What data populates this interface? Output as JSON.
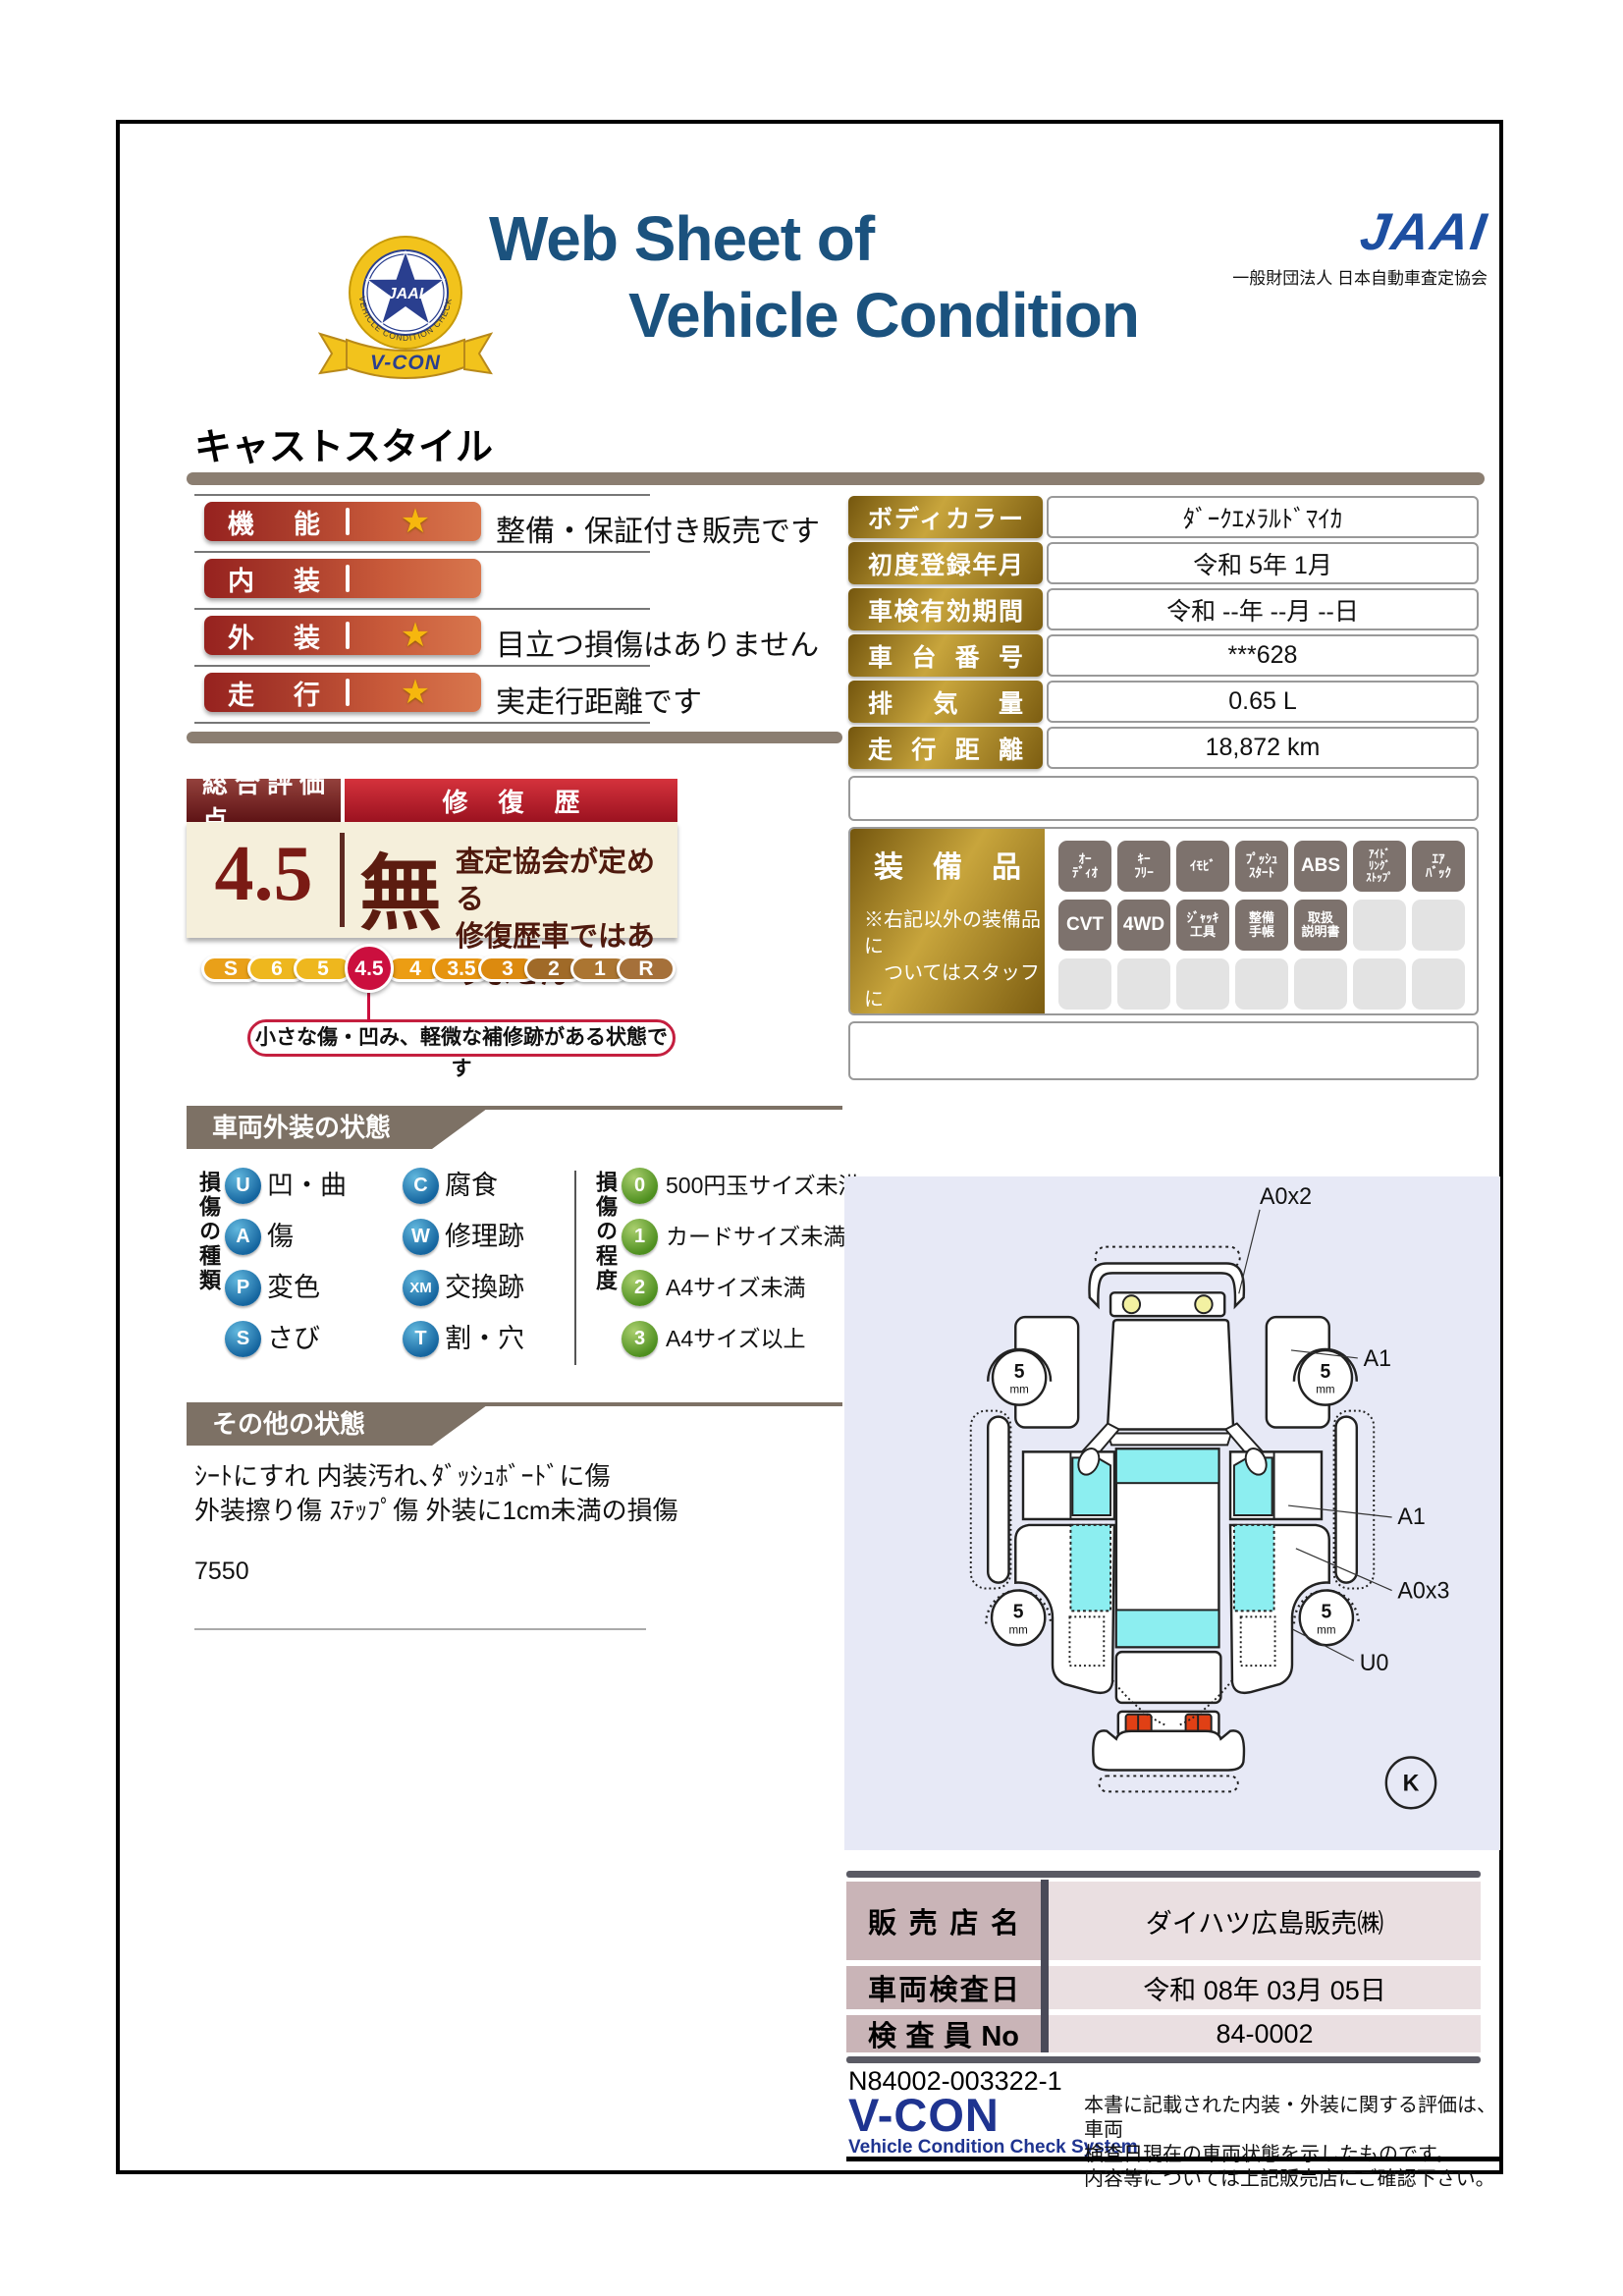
{
  "colors": {
    "title_blue": "#1b527e",
    "jaai_blue": "#1d4fa1",
    "accent_red": "#c41f3f",
    "maroon": "#5e1315",
    "bar_red": "#96221f",
    "gold": "#c8a53c",
    "cyan": "#8ceef0",
    "lavender": "#e7e9f6",
    "banner_gray": "#7d7165",
    "pink_label": "#c9b4b7",
    "selected_grade": "#cb0f3e"
  },
  "header": {
    "title_line1": "Web Sheet of",
    "title_line2": "Vehicle Condition",
    "jaai_word": "JAAI",
    "jaai_org": "一般財団法人 日本自動車査定協会",
    "badge_ring": "VEHICLE CONDITION CHECK SYSTEM",
    "badge_star": "JAAI",
    "badge_ribbon": "V-CON"
  },
  "vehicle_name": "キャストスタイル",
  "icons": {
    "star": "★"
  },
  "ratings": [
    {
      "label": "機能",
      "description": "整備・保証付き販売です"
    },
    {
      "label": "内装",
      "description": ""
    },
    {
      "label": "外装",
      "description": "目立つ損傷はありません"
    },
    {
      "label": "走行",
      "description": "実走行距離です"
    }
  ],
  "spec": {
    "rows": [
      {
        "label": "ボディカラー",
        "value": "ﾀﾞｰｸｴﾒﾗﾙﾄﾞﾏｲｶ"
      },
      {
        "label": "初度登録年月",
        "value": "令和 5年 1月"
      },
      {
        "label": "車検有効期間",
        "value": "令和 --年 --月 --日"
      },
      {
        "label": "車台番号",
        "value": "***628"
      },
      {
        "label": "排気量",
        "value": "0.65 L"
      },
      {
        "label": "走行距離",
        "value": "18,872 km"
      }
    ]
  },
  "overall": {
    "header_score": "総合評価点",
    "header_repair": "修復歴",
    "score": "4.5",
    "repair": "無",
    "repair_note": "査定協会が定める\n修復歴車ではありません",
    "scale": [
      "S",
      "6",
      "5",
      "4.5",
      "4",
      "3.5",
      "3",
      "2",
      "1",
      "R"
    ],
    "selected": "4.5",
    "callout": "小さな傷・凹み、軽微な補修跡がある状態です"
  },
  "equipment": {
    "title": "装備品",
    "note": "※右記以外の装備品に\n　ついてはスタッフに\n　お尋ねください。",
    "items": [
      "ｵｰ\nﾃﾞｨｵ",
      "ｷｰ\nﾌﾘｰ",
      "ｲﾓﾋﾞ",
      "ﾌﾟｯｼｭ\nｽﾀｰﾄ",
      "ABS",
      "ｱｲﾄﾞ\nﾘﾝｸﾞ\nｽﾄｯﾌﾟ",
      "ｴｱ\nﾊﾞｯｸ",
      "CVT",
      "4WD",
      "ｼﾞｬｯｷ\n工具",
      "整備\n手帳",
      "取扱\n説明書"
    ]
  },
  "exterior": {
    "banner": "車両外装の状態",
    "kind_title": "損傷の種類",
    "kinds": [
      {
        "code": "U",
        "label": "凹・曲"
      },
      {
        "code": "A",
        "label": "傷"
      },
      {
        "code": "P",
        "label": "変色"
      },
      {
        "code": "S",
        "label": "さび"
      },
      {
        "code": "C",
        "label": "腐食"
      },
      {
        "code": "W",
        "label": "修理跡"
      },
      {
        "code": "XM",
        "label": "交換跡"
      },
      {
        "code": "T",
        "label": "割・穴"
      }
    ],
    "degree_title": "損傷の程度",
    "degrees": [
      {
        "code": "0",
        "label": "500円玉サイズ未満"
      },
      {
        "code": "1",
        "label": "カードサイズ未満"
      },
      {
        "code": "2",
        "label": "A4サイズ未満"
      },
      {
        "code": "3",
        "label": "A4サイズ以上"
      }
    ]
  },
  "other_state": {
    "banner": "その他の状態",
    "text": "ｼｰﾄにすれ 内装汚れ､ﾀﾞｯｼｭﾎﾞｰﾄﾞに傷\n外装擦り傷 ｽﾃｯﾌﾟ傷 外装に1cm未満の損傷",
    "code": "7550"
  },
  "diagram": {
    "label_front_bumper": "A0x2",
    "label_fender": "A1",
    "label_door": "A1",
    "label_quarter": "A0x3",
    "label_wheel_arch": "U0",
    "label_grade": "K",
    "wheel_value": "5",
    "wheel_unit": "mm"
  },
  "dealer": {
    "rows": [
      {
        "label": "販売店名",
        "value": "ダイハツ広島販売㈱"
      },
      {
        "label": "車両検査日",
        "value": "令和 08年 03月 05日"
      },
      {
        "label": "検査員No",
        "value": "84-0002"
      }
    ]
  },
  "footer": {
    "serial": "N84002-003322-1",
    "vcon": "V-CON",
    "vcon_sub": "Vehicle Condition Check System",
    "disclaimer": "本書に記載された内装・外装に関する評価は、車両\n検査日現在の車両状態を示したものです。\n内容等については上記販売店にご確認下さい。"
  }
}
